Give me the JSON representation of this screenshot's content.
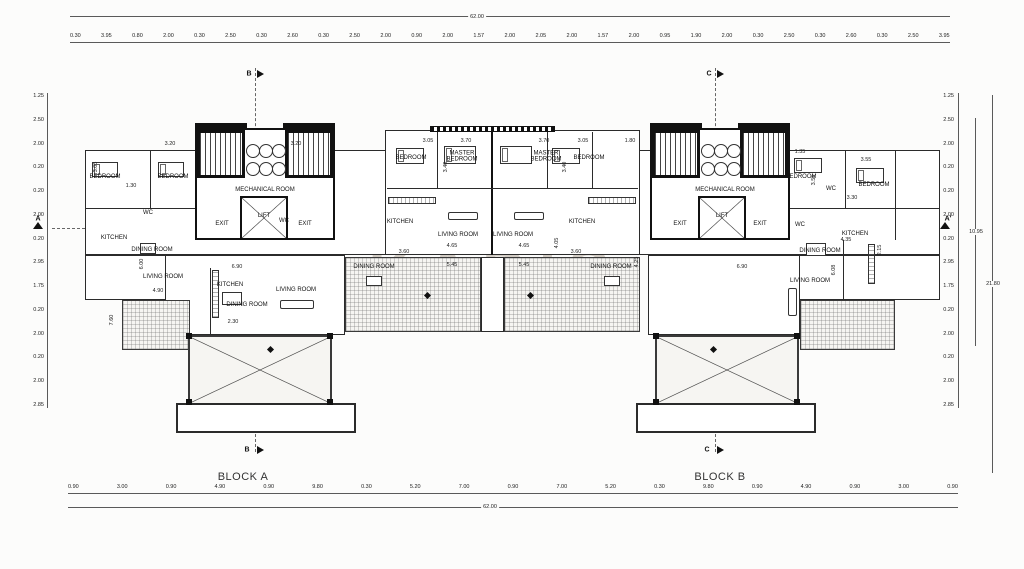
{
  "watermark": {
    "line1": "KADIS",
    "line2": "ESTATES"
  },
  "block_labels": {
    "a": "BLOCK A",
    "b": "BLOCK B"
  },
  "section_markers": {
    "a": "A",
    "a_prime": "A'",
    "b": "B",
    "c": "C"
  },
  "dims": {
    "top_total": "62.00",
    "bottom_total": "62.00",
    "right_total_inner": "10.95",
    "right_total_outer": "21.80",
    "top_chain": [
      "0.30",
      "3.95",
      "0.80",
      "2.00",
      "0.30",
      "2.50",
      "0.30",
      "2.60",
      "0.30",
      "2.50",
      "2.00",
      "0.90",
      "2.00",
      "1.57",
      "2.00",
      "2.05",
      "2.00",
      "1.57",
      "2.00",
      "0.95",
      "1.90",
      "2.00",
      "0.30",
      "2.50",
      "0.30",
      "2.60",
      "0.30",
      "2.50",
      "3.95"
    ],
    "bottom_chain": [
      "0.90",
      "3.00",
      "0.90",
      "4.90",
      "0.90",
      "9.80",
      "0.30",
      "5.20",
      "7.00",
      "0.90",
      "7.00",
      "5.20",
      "0.30",
      "9.80",
      "0.90",
      "4.90",
      "0.90",
      "3.00",
      "0.90"
    ],
    "left_chain": [
      "1.25",
      "2.50",
      "2.00",
      "0.20",
      "0.20",
      "2.00",
      "0.20",
      "2.95",
      "1.75",
      "0.20",
      "2.00",
      "0.20",
      "2.00",
      "2.85"
    ],
    "right_chain": [
      "1.25",
      "2.50",
      "2.00",
      "0.20",
      "0.20",
      "2.00",
      "0.20",
      "2.95",
      "1.75",
      "0.20",
      "2.00",
      "0.20",
      "2.00",
      "2.85"
    ]
  },
  "rooms": [
    "BEDROOM",
    "BEDROOM",
    "MECHANICAL ROOM",
    "LIFT",
    "EXIT",
    "EXIT",
    "KITCHEN",
    "DINING ROOM",
    "LIVING ROOM",
    "KITCHEN",
    "DINING ROOM",
    "LIVING ROOM",
    "BEDROOM",
    "MASTER BEDROOM",
    "MASTER BEDROOM",
    "BEDROOM",
    "KITCHEN",
    "LIVING ROOM",
    "LIVING ROOM",
    "KITCHEN",
    "DINING ROOM",
    "MECHANICAL ROOM",
    "LIFT",
    "EXIT",
    "EXIT",
    "BEDROOM",
    "BEDROOM",
    "KITCHEN",
    "DINING ROOM",
    "LIVING ROOM",
    "WC",
    "WC",
    "WC",
    "WC",
    "DINING ROOM"
  ],
  "plan_dims": [
    "3.05",
    "3.70",
    "3.70",
    "3.05",
    "1.80",
    "3.40",
    "3.40",
    "4.65",
    "4.65",
    "5.45",
    "5.45",
    "4.05",
    "3.60",
    "3.60",
    "6.90",
    "2.30",
    "7.60",
    "6.00",
    "4.90",
    "4.35",
    "2.15",
    "6.08",
    "3.55",
    "3.30",
    "1.35",
    "3.55",
    "1.30",
    "3.05",
    "3.20",
    "3.20",
    "6.90",
    "4.25"
  ]
}
